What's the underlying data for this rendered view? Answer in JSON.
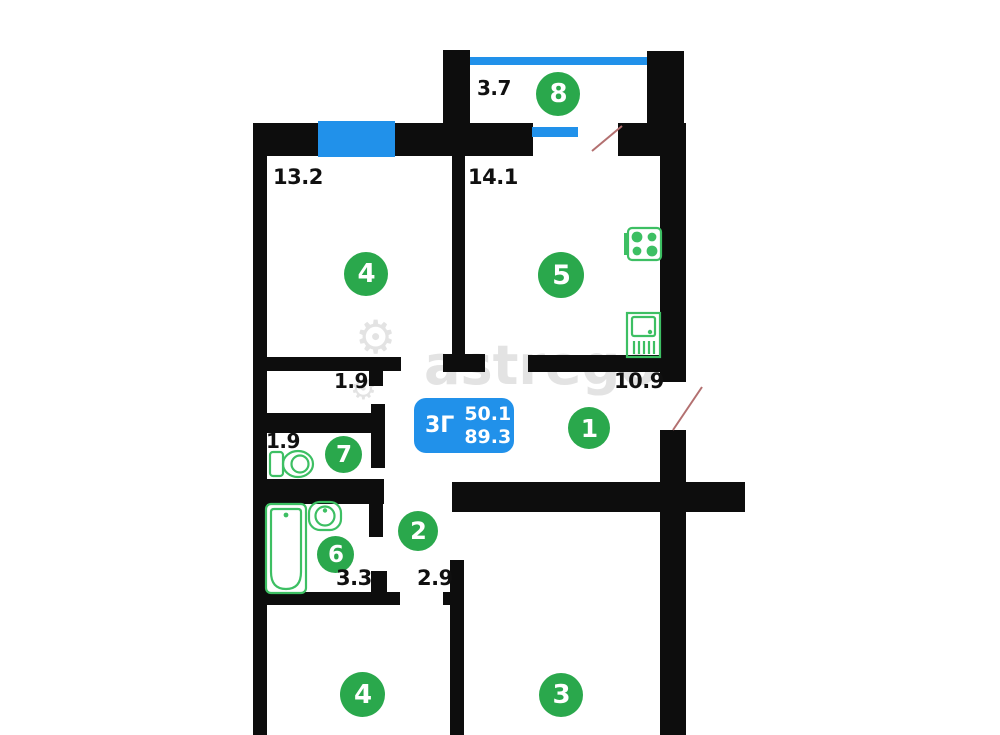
{
  "palette": {
    "bg": "#ffffff",
    "wall": "#0d0d0d",
    "green": "#2aa84c",
    "fixture": "#3dbf63",
    "blue": "#2191ea",
    "door": "#b37070",
    "label": "#101010",
    "watermark": "#e3e3e3"
  },
  "badge": {
    "type": "3Г",
    "living_area": "50.1",
    "total_area": "89.3"
  },
  "watermark": {
    "text": "astrego",
    "gear": "⚙"
  },
  "rooms": {
    "balcony": {
      "number": "8",
      "area": "3.7"
    },
    "bedroom_top": {
      "number": "4",
      "area": "13.2"
    },
    "kitchen": {
      "number": "5",
      "area": "14.1"
    },
    "hallway": {
      "number": "1",
      "area": "10.9"
    },
    "corridor": {
      "area": "1.9"
    },
    "toilet": {
      "number": "7",
      "area": "1.9"
    },
    "hall": {
      "number": "2"
    },
    "bathroom": {
      "number": "6",
      "area": "3.3"
    },
    "passage": {
      "area": "2.9"
    },
    "room_bottom_left": {
      "number": "4"
    },
    "room_bottom_right": {
      "number": "3"
    }
  },
  "icons": [
    "stove-icon",
    "kitchen-sink-icon",
    "toilet-icon",
    "bathtub-icon",
    "washbasin-icon",
    "gear-icon",
    "window",
    "door-swing"
  ]
}
